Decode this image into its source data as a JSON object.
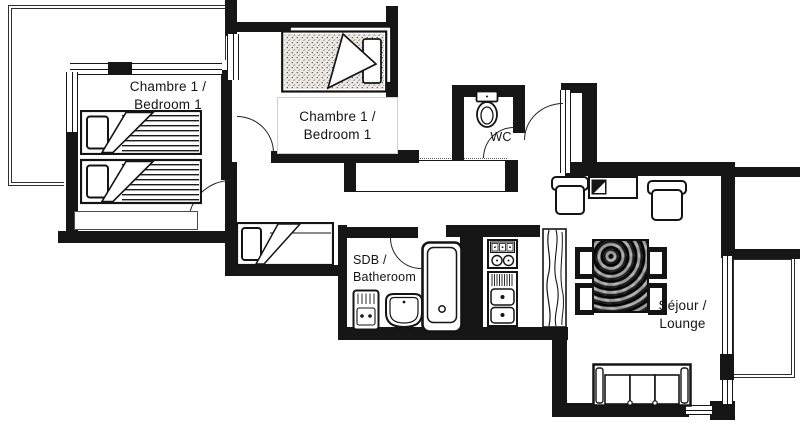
{
  "labels": {
    "bedroom_a_line1": "Chambre 1 /",
    "bedroom_a_line2": "Bedroom 1",
    "bedroom_b_line1": "Chambre 1 /",
    "bedroom_b_line2": "Bedroom 1",
    "wc": "WC",
    "bathroom_line1": "SDB /",
    "bathroom_line2": "Batheroom",
    "lounge_line1": "Séjour /",
    "lounge_line2": "Lounge"
  },
  "colors": {
    "wall": "#161616",
    "floor": "#ffffff",
    "line": "#222222",
    "table_wood": "#4a4a4a"
  }
}
